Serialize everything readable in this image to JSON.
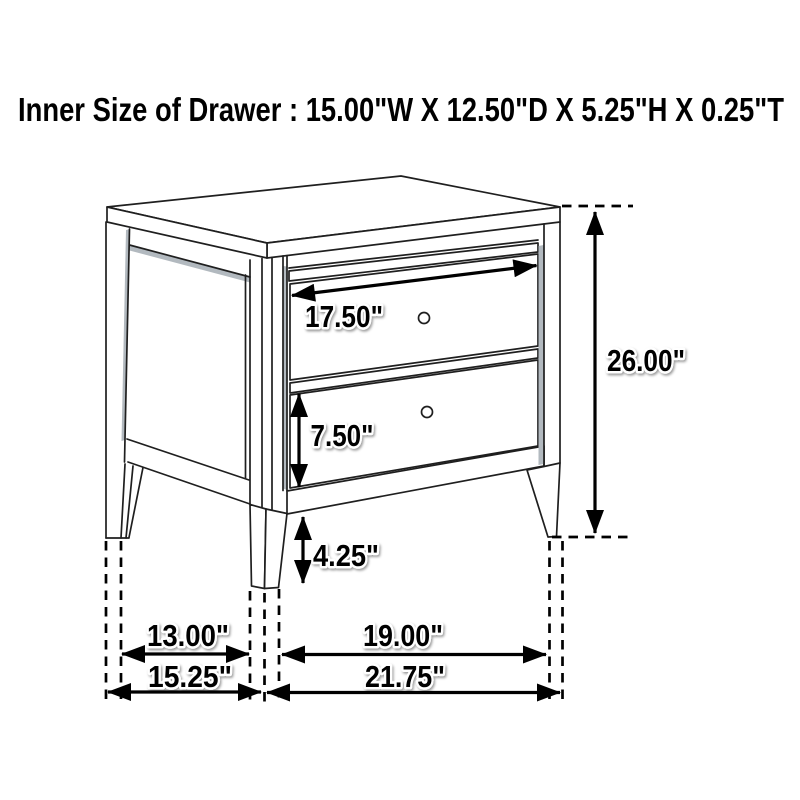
{
  "title": "Inner Size of Drawer : 15.00\"W X 12.50\"D X 5.25\"H X 0.25\"T",
  "description": "Technical dimension diagram of a two-drawer nightstand, line drawing with measurement arrows",
  "inner_drawer_size": {
    "width": "15.00\"",
    "depth": "12.50\"",
    "height": "5.25\"",
    "thickness": "0.25\""
  },
  "labels": {
    "drawer_width": "17.50\"",
    "drawer_height": "7.50\"",
    "foot_height": "4.25\"",
    "overall_height": "26.00\"",
    "inner_depth": "13.00\"",
    "inner_width": "19.00\"",
    "overall_depth": "15.25\"",
    "overall_width": "21.75\""
  },
  "colors": {
    "line": "#1f1f1f",
    "dimension": "#000000",
    "background": "#ffffff",
    "shading": "#b2b9bf"
  }
}
